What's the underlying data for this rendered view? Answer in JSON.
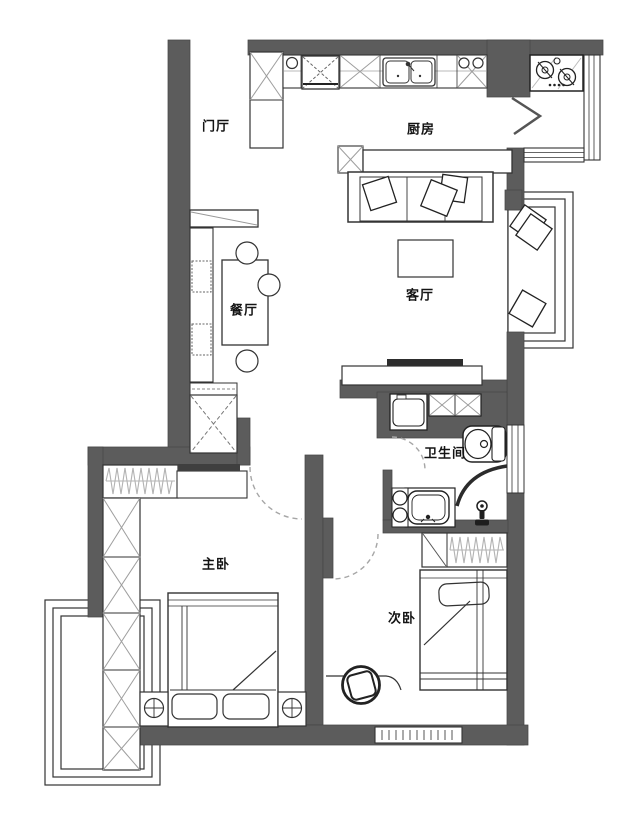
{
  "plan": {
    "rooms": [
      {
        "name": "entry",
        "label": "门厅"
      },
      {
        "name": "kitchen",
        "label": "厨房"
      },
      {
        "name": "living-room",
        "label": "客厅"
      },
      {
        "name": "dining-room",
        "label": "餐厅"
      },
      {
        "name": "bathroom",
        "label": "卫生间"
      },
      {
        "name": "master-bedroom",
        "label": "主卧"
      },
      {
        "name": "second-bedroom",
        "label": "次卧"
      }
    ],
    "colors": {
      "wall": "#5c5c5c",
      "line": "#333333",
      "hatch": "#9e9e9e",
      "door_arc": "#a6a6a6",
      "background": "#ffffff"
    }
  }
}
